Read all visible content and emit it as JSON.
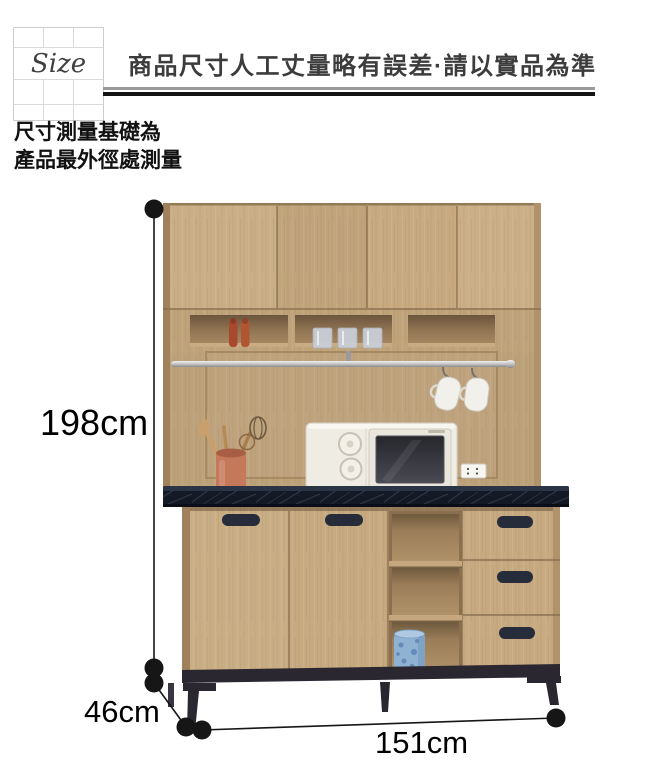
{
  "page": {
    "width": 650,
    "height": 762,
    "background": "#FFFFFF"
  },
  "header": {
    "size_label": "Size",
    "notice": "商品尺寸人工丈量略有誤差·請以實品為準"
  },
  "note": {
    "line1": "尺寸測量基礎為",
    "line2": "產品最外徑處測量"
  },
  "dimensions": {
    "height": "198cm",
    "depth": "46cm",
    "width": "151cm"
  },
  "illustration": {
    "subject": "kitchen-sideboard-with-hutch-and-microwave",
    "visible_items": [
      "pepper-mills",
      "drinking-glasses",
      "hanging-rail",
      "hanging-cups",
      "utensil-holder",
      "microwave",
      "power-outlet",
      "blue-jar"
    ],
    "colors": {
      "wood": "#C7AA81",
      "wood_shadow": "#8B7150",
      "countertop_marble": "#141A25",
      "hardware_navy": "#272C3B",
      "leg_metal": "#2B2731",
      "microwave_body": "#EFECE4",
      "dimension_line": "#161616"
    }
  }
}
